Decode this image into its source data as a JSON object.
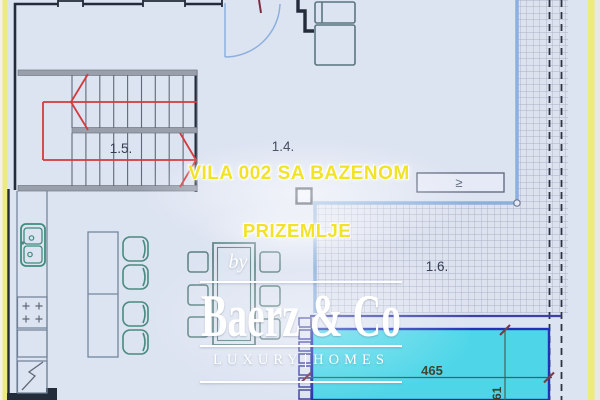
{
  "plan": {
    "titles": {
      "main": "VILA 002 SA BAZENOM",
      "floor": "PRIZEMLJE"
    },
    "room_labels": {
      "stairs": "1.5.",
      "living": "1.4.",
      "terrace": "1.6."
    },
    "dimensions": {
      "pool_width": "465",
      "pool_side": "61"
    },
    "marker_glyph": "≥"
  },
  "watermark": {
    "by": "by",
    "brand": "Baerz & Co",
    "tagline_left": "LUXURY",
    "tagline_right": "HOMES"
  },
  "colors": {
    "accent_yellow_text": "#f2e228",
    "page_border_yellow": "#edeb7e",
    "pool_cyan": "#4ed6e8",
    "pool_border_blue": "#2232b2",
    "stair_arrow_red": "#d33a3e",
    "wall_dark": "#232c3a",
    "glass_line_blue": "#8cb0dd",
    "terrace_indigo": "#3c40a8",
    "watermark_white": "#ffffff",
    "background_blue": "#dce3f1"
  }
}
